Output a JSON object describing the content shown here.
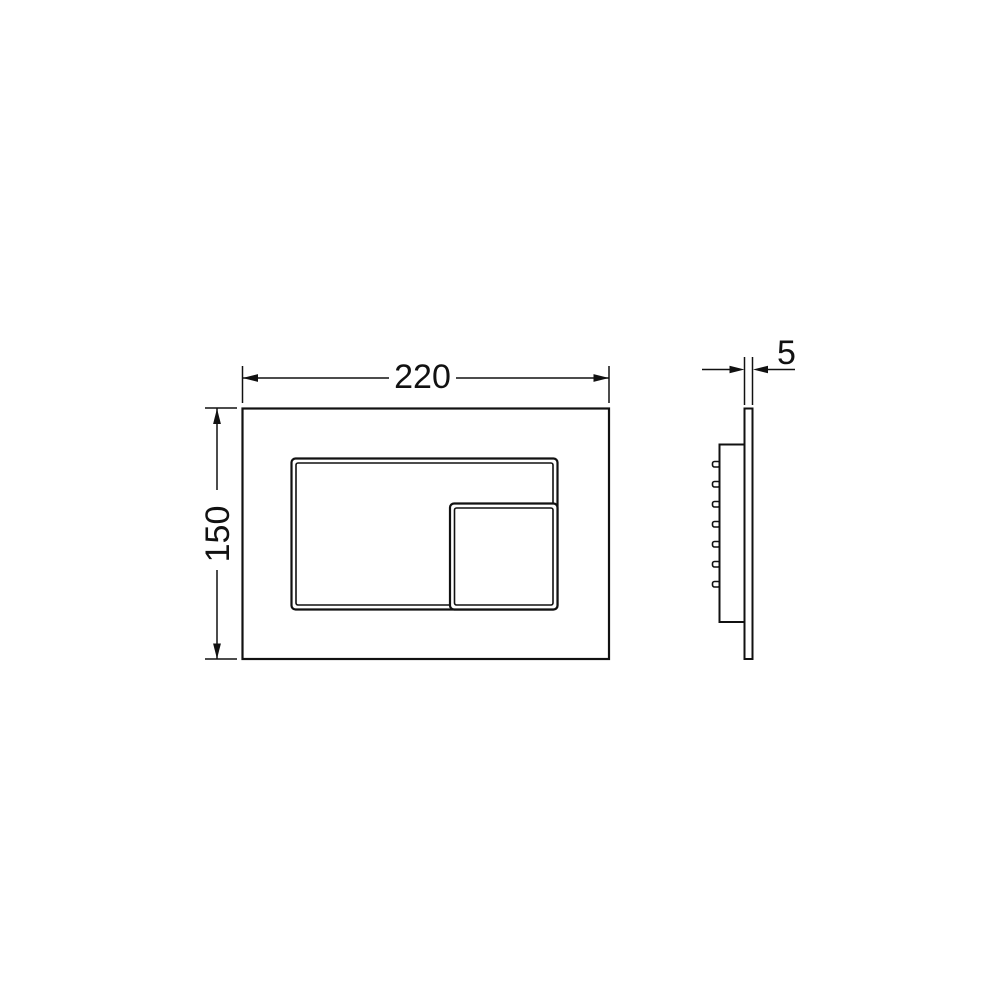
{
  "drawing": {
    "background_color": "#ffffff",
    "line_color": "#111111",
    "labels": {
      "width": "220",
      "height": "150",
      "thickness": "5"
    }
  }
}
